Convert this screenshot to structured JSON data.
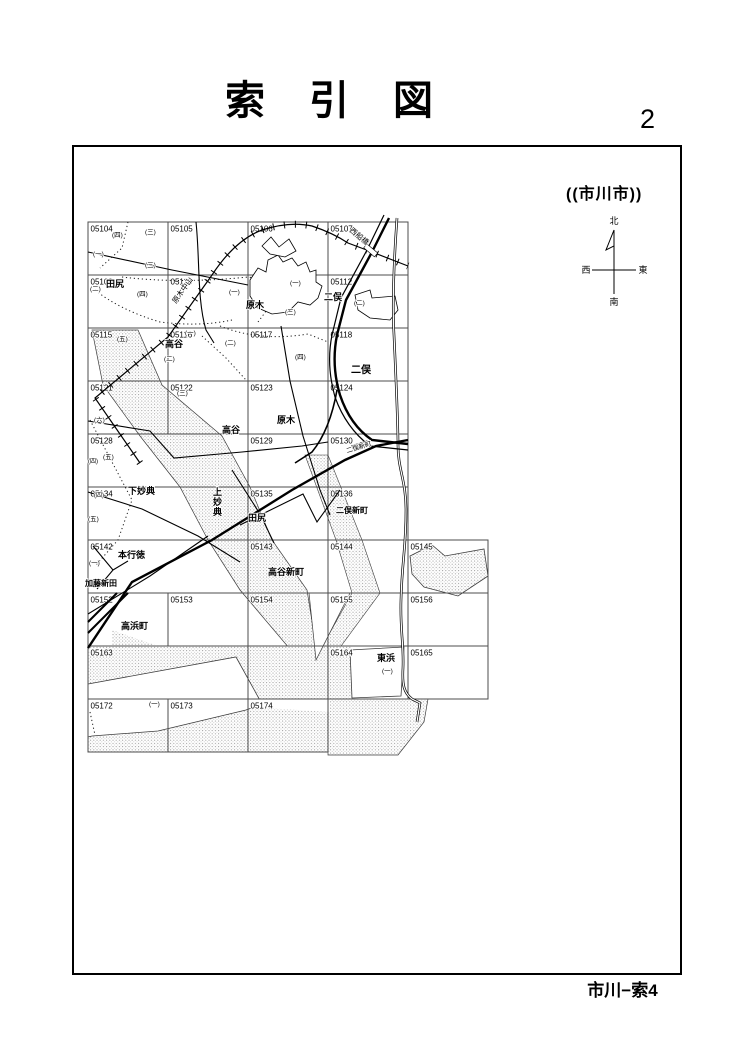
{
  "page": {
    "title": "索　引　図",
    "page_number": "2",
    "city_label": "((市川市))",
    "footer": "市川−索4"
  },
  "compass": {
    "north": "北",
    "south": "南",
    "east": "東",
    "west": "西"
  },
  "grid_cells": [
    {
      "id": "05104",
      "x": 88,
      "y": 222,
      "w": 80,
      "h": 53
    },
    {
      "id": "05105",
      "x": 168,
      "y": 222,
      "w": 80,
      "h": 53
    },
    {
      "id": "05106",
      "x": 248,
      "y": 222,
      "w": 80,
      "h": 53
    },
    {
      "id": "05107",
      "x": 328,
      "y": 222,
      "w": 80,
      "h": 53
    },
    {
      "id": "05109",
      "x": 88,
      "y": 275,
      "w": 80,
      "h": 53
    },
    {
      "id": "05110",
      "x": 168,
      "y": 275,
      "w": 80,
      "h": 53
    },
    {
      "id": "05111",
      "x": 248,
      "y": 275,
      "w": 80,
      "h": 53
    },
    {
      "id": "05112",
      "x": 328,
      "y": 275,
      "w": 80,
      "h": 53
    },
    {
      "id": "05115",
      "x": 88,
      "y": 328,
      "w": 80,
      "h": 53
    },
    {
      "id": "05116",
      "x": 168,
      "y": 328,
      "w": 80,
      "h": 53
    },
    {
      "id": "05117",
      "x": 248,
      "y": 328,
      "w": 80,
      "h": 53
    },
    {
      "id": "05118",
      "x": 328,
      "y": 328,
      "w": 80,
      "h": 53
    },
    {
      "id": "05121",
      "x": 88,
      "y": 381,
      "w": 80,
      "h": 53
    },
    {
      "id": "05122",
      "x": 168,
      "y": 381,
      "w": 80,
      "h": 53
    },
    {
      "id": "05123",
      "x": 248,
      "y": 381,
      "w": 80,
      "h": 53
    },
    {
      "id": "05124",
      "x": 328,
      "y": 381,
      "w": 80,
      "h": 53
    },
    {
      "id": "05128",
      "x": 88,
      "y": 434,
      "w": 160,
      "h": 53
    },
    {
      "id": "05129",
      "x": 248,
      "y": 434,
      "w": 80,
      "h": 53
    },
    {
      "id": "05130",
      "x": 328,
      "y": 434,
      "w": 80,
      "h": 53
    },
    {
      "id": "05134",
      "x": 88,
      "y": 487,
      "w": 160,
      "h": 53
    },
    {
      "id": "05135",
      "x": 248,
      "y": 487,
      "w": 80,
      "h": 53
    },
    {
      "id": "05136",
      "x": 328,
      "y": 487,
      "w": 80,
      "h": 53
    },
    {
      "id": "05142",
      "x": 88,
      "y": 540,
      "w": 160,
      "h": 53
    },
    {
      "id": "05143",
      "x": 248,
      "y": 540,
      "w": 80,
      "h": 53
    },
    {
      "id": "05144",
      "x": 328,
      "y": 540,
      "w": 80,
      "h": 53
    },
    {
      "id": "05145",
      "x": 408,
      "y": 540,
      "w": 80,
      "h": 53
    },
    {
      "id": "05152",
      "x": 88,
      "y": 593,
      "w": 80,
      "h": 53
    },
    {
      "id": "05153",
      "x": 168,
      "y": 593,
      "w": 80,
      "h": 53
    },
    {
      "id": "05154",
      "x": 248,
      "y": 593,
      "w": 80,
      "h": 53
    },
    {
      "id": "05155",
      "x": 328,
      "y": 593,
      "w": 80,
      "h": 53
    },
    {
      "id": "05156",
      "x": 408,
      "y": 593,
      "w": 80,
      "h": 53
    },
    {
      "id": "05163",
      "x": 88,
      "y": 646,
      "w": 160,
      "h": 53
    },
    {
      "id": "",
      "x": 248,
      "y": 646,
      "w": 80,
      "h": 53
    },
    {
      "id": "05164",
      "x": 328,
      "y": 646,
      "w": 80,
      "h": 53
    },
    {
      "id": "05165",
      "x": 408,
      "y": 646,
      "w": 80,
      "h": 53
    },
    {
      "id": "05172",
      "x": 88,
      "y": 699,
      "w": 80,
      "h": 53
    },
    {
      "id": "05173",
      "x": 168,
      "y": 699,
      "w": 80,
      "h": 53
    },
    {
      "id": "05174",
      "x": 248,
      "y": 699,
      "w": 80,
      "h": 53
    }
  ],
  "map_labels": [
    {
      "t": "(四)",
      "x": 112,
      "y": 237,
      "s": 6.5
    },
    {
      "t": "(三)",
      "x": 145,
      "y": 234,
      "s": 6.5
    },
    {
      "t": "(一)",
      "x": 93,
      "y": 256,
      "s": 6.5
    },
    {
      "t": "(三)",
      "x": 145,
      "y": 267,
      "s": 6.5
    },
    {
      "t": "(二)",
      "x": 90,
      "y": 291,
      "s": 6.5
    },
    {
      "t": "田尻",
      "x": 106,
      "y": 287,
      "s": 9,
      "b": 1
    },
    {
      "t": "(四)",
      "x": 137,
      "y": 296,
      "s": 6.5
    },
    {
      "t": "(一)",
      "x": 229,
      "y": 294,
      "s": 6.5
    },
    {
      "t": "原木中山",
      "x": 176,
      "y": 304,
      "s": 7.5,
      "r": -55
    },
    {
      "t": "西船橋",
      "x": 349,
      "y": 231,
      "s": 7.5,
      "r": 40
    },
    {
      "t": "(一)",
      "x": 290,
      "y": 285,
      "s": 6.5
    },
    {
      "t": "原木",
      "x": 246,
      "y": 308,
      "s": 9,
      "b": 1
    },
    {
      "t": "(三)",
      "x": 285,
      "y": 314,
      "s": 6.5
    },
    {
      "t": "二俣",
      "x": 324,
      "y": 300,
      "s": 9,
      "b": 1
    },
    {
      "t": "(二)",
      "x": 354,
      "y": 305,
      "s": 6.5
    },
    {
      "t": "(五)",
      "x": 117,
      "y": 341,
      "s": 6.5
    },
    {
      "t": "(一)",
      "x": 185,
      "y": 335,
      "s": 6.5
    },
    {
      "t": "高谷",
      "x": 165,
      "y": 347,
      "s": 9,
      "b": 1
    },
    {
      "t": "(二)",
      "x": 164,
      "y": 361,
      "s": 6.5
    },
    {
      "t": "(二)",
      "x": 225,
      "y": 345,
      "s": 6.5
    },
    {
      "t": "(四)",
      "x": 295,
      "y": 359,
      "s": 6.5
    },
    {
      "t": "二俣",
      "x": 351,
      "y": 373,
      "s": 10,
      "b": 1
    },
    {
      "t": "(六)",
      "x": 94,
      "y": 422,
      "s": 6.5
    },
    {
      "t": "(三)",
      "x": 177,
      "y": 395,
      "s": 6.5
    },
    {
      "t": "原木",
      "x": 277,
      "y": 423,
      "s": 9,
      "b": 1
    },
    {
      "t": "(四)",
      "x": 88,
      "y": 463,
      "s": 6
    },
    {
      "t": "(五)",
      "x": 103,
      "y": 459,
      "s": 6.5
    },
    {
      "t": "高谷",
      "x": 222,
      "y": 433,
      "s": 9,
      "b": 1
    },
    {
      "t": "二俣新町",
      "x": 347,
      "y": 453,
      "s": 6.5,
      "r": -17
    },
    {
      "t": "(四)",
      "x": 94,
      "y": 497,
      "s": 6
    },
    {
      "t": "(五)",
      "x": 88,
      "y": 521,
      "s": 6.5
    },
    {
      "t": "下妙典",
      "x": 128,
      "y": 494,
      "s": 9,
      "b": 1
    },
    {
      "t": "上妙典",
      "x": 213,
      "y": 495,
      "s": 9,
      "b": 1,
      "vert": 1
    },
    {
      "t": "田尻",
      "x": 248,
      "y": 521,
      "s": 9,
      "b": 1
    },
    {
      "t": "二俣新町",
      "x": 336,
      "y": 513,
      "s": 8,
      "b": 1
    },
    {
      "t": "(一)",
      "x": 89,
      "y": 565,
      "s": 6.5
    },
    {
      "t": "本行徳",
      "x": 118,
      "y": 558,
      "s": 9,
      "b": 1
    },
    {
      "t": "加藤新田",
      "x": 85,
      "y": 586,
      "s": 8,
      "b": 1
    },
    {
      "t": "高谷新町",
      "x": 268,
      "y": 575,
      "s": 9,
      "b": 1
    },
    {
      "t": "高浜町",
      "x": 121,
      "y": 629,
      "s": 9,
      "b": 1
    },
    {
      "t": "東浜",
      "x": 377,
      "y": 661,
      "s": 9,
      "b": 1
    },
    {
      "t": "(一)",
      "x": 382,
      "y": 673,
      "s": 6.5
    },
    {
      "t": "(一)",
      "x": 149,
      "y": 706,
      "s": 6.5
    }
  ]
}
